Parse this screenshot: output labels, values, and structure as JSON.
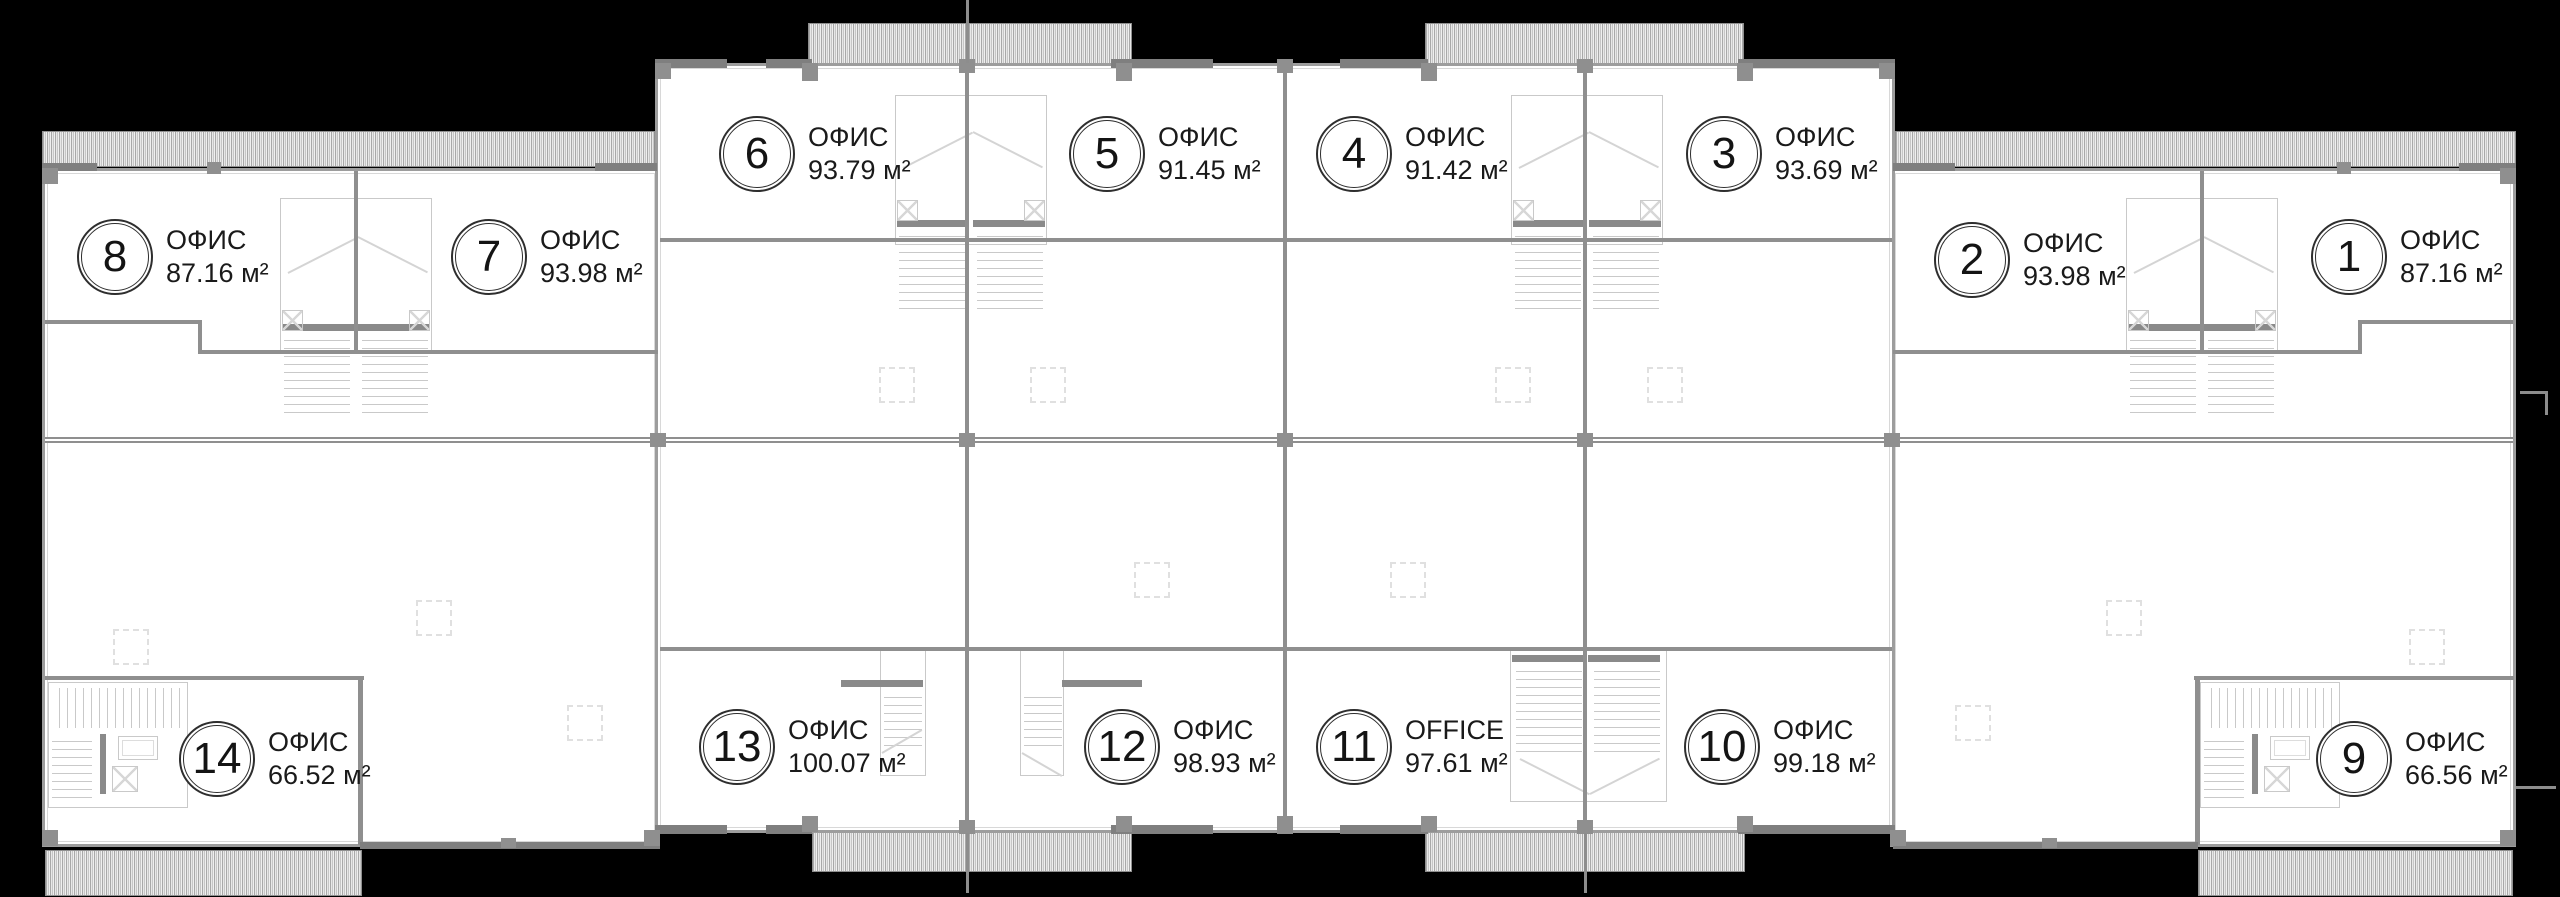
{
  "plan": {
    "colors": {
      "background": "#000000",
      "wall": "#8f8f8f",
      "window_wall": "#d8d8d8",
      "hatch": "#c6c6c6",
      "text": "#1a1a1a"
    },
    "area_unit": "м²",
    "units": [
      {
        "number": "1",
        "label": "ОФИС",
        "area": "87.16 м²",
        "cx": 2347,
        "cy": 255
      },
      {
        "number": "2",
        "label": "ОФИС",
        "area": "93.98 м²",
        "cx": 1970,
        "cy": 258
      },
      {
        "number": "3",
        "label": "ОФИС",
        "area": "93.69 м²",
        "cx": 1722,
        "cy": 152
      },
      {
        "number": "4",
        "label": "ОФИС",
        "area": "91.42 м²",
        "cx": 1352,
        "cy": 152
      },
      {
        "number": "5",
        "label": "ОФИС",
        "area": "91.45 м²",
        "cx": 1105,
        "cy": 152
      },
      {
        "number": "6",
        "label": "ОФИС",
        "area": "93.79 м²",
        "cx": 755,
        "cy": 152
      },
      {
        "number": "7",
        "label": "ОФИС",
        "area": "93.98 м²",
        "cx": 487,
        "cy": 255
      },
      {
        "number": "8",
        "label": "ОФИС",
        "area": "87.16 м²",
        "cx": 113,
        "cy": 255
      },
      {
        "number": "9",
        "label": "ОФИС",
        "area": "66.56 м²",
        "cx": 2352,
        "cy": 757
      },
      {
        "number": "10",
        "label": "ОФИС",
        "area": "99.18 м²",
        "cx": 1720,
        "cy": 745
      },
      {
        "number": "11",
        "label": "OFFICE",
        "area": "97.61 м²",
        "cx": 1352,
        "cy": 745
      },
      {
        "number": "12",
        "label": "ОФИС",
        "area": "98.93 м²",
        "cx": 1120,
        "cy": 745
      },
      {
        "number": "13",
        "label": "ОФИС",
        "area": "100.07 м²",
        "cx": 735,
        "cy": 745
      },
      {
        "number": "14",
        "label": "ОФИС",
        "area": "66.52 м²",
        "cx": 215,
        "cy": 757
      }
    ]
  }
}
